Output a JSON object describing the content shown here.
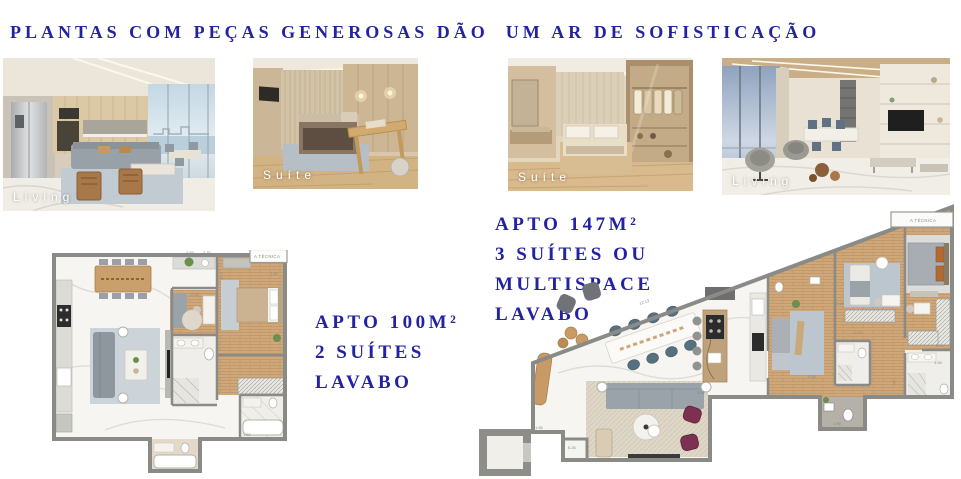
{
  "page": {
    "title": "PLANTAS COM PEÇAS GENEROSAS DÃO  UM AR DE SOFISTICAÇÃO"
  },
  "photos": [
    {
      "label": "Living"
    },
    {
      "label": "Suíte"
    },
    {
      "label": "Suíte"
    },
    {
      "label": "Living"
    }
  ],
  "apartments": {
    "apto100": {
      "lines": [
        "APTO 100M²",
        "2 SUÍTES",
        "LAVABO"
      ]
    },
    "apto147": {
      "lines": [
        "APTO 147M²",
        "3 SUÍTES OU",
        "MULTISPACE",
        "LAVABO"
      ]
    }
  },
  "floorplans": {
    "left": {
      "tech_label": "A TÉCNICA",
      "dims": [
        "4.84",
        "2.70",
        "2.56",
        "3.06",
        "2.50",
        "1.50"
      ]
    },
    "right": {
      "tech_label": "A TÉCNICA",
      "dims": [
        "12.13",
        "3.26",
        "2.55",
        "2.68",
        "1.83",
        "4.47",
        "7.00",
        "3.00",
        "1.94",
        "1.65",
        "5.26",
        "1.95"
      ]
    }
  },
  "colors": {
    "accent_navy": "#2222a2",
    "wall_gray": "#8a8a86",
    "wood_floor": "#cfa87a",
    "marble_floor": "#f6f5f1"
  }
}
